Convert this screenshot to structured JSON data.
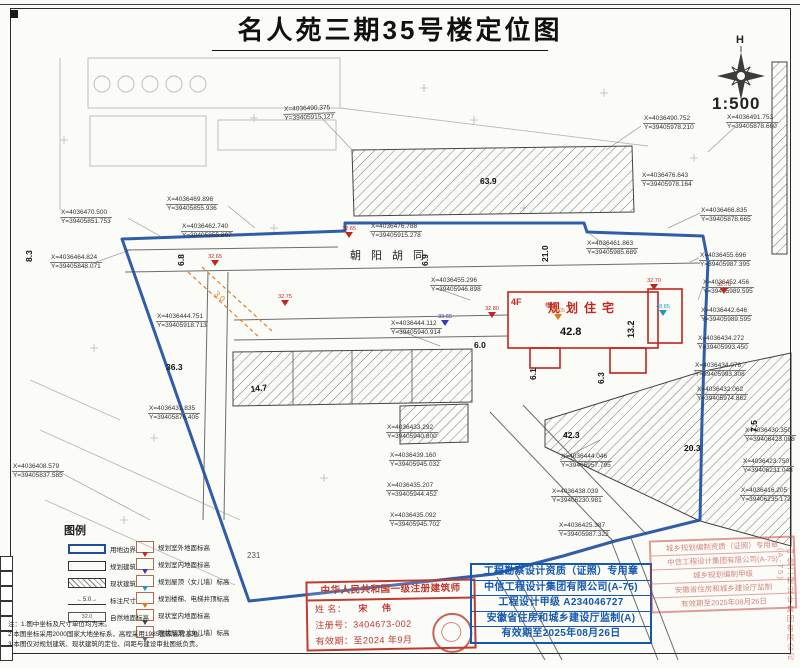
{
  "title": "名人苑三期35号楼定位图",
  "compass": {
    "north_label": "H",
    "scale": "1:500"
  },
  "map": {
    "street_name": "朝阳胡同",
    "building": {
      "floors": "4F",
      "label": "规划住宅",
      "width": "42.8",
      "depth": "13.2",
      "stair_label": "楼梯"
    },
    "orange_annotation": "3.0",
    "parcel_number": "231",
    "coord_labels": [
      {
        "x": 283,
        "y": 106,
        "rot": -2,
        "X": "X=4036490.375",
        "Y": "Y=39405915.127"
      },
      {
        "x": 643,
        "y": 115,
        "X": "X=4036490.752",
        "Y": "Y=39405978.210"
      },
      {
        "x": 641,
        "y": 172,
        "X": "X=4036476.643",
        "Y": "Y=39405978.164"
      },
      {
        "x": 726,
        "y": 114,
        "X": "X=4036491.753",
        "Y": "Y=39405878.660"
      },
      {
        "x": 700,
        "y": 207,
        "X": "X=4036466.835",
        "Y": "Y=39405878.665"
      },
      {
        "x": 166,
        "y": 196,
        "X": "X=4036469.896",
        "Y": "Y=39405855.936"
      },
      {
        "x": 60,
        "y": 209,
        "X": "X=4036470.500",
        "Y": "Y=39405851.753"
      },
      {
        "x": 181,
        "y": 223,
        "X": "X=4036462.740",
        "Y": "Y=39405855.897"
      },
      {
        "x": 370,
        "y": 223,
        "X": "X=4036476.788",
        "Y": "Y=39405915.278"
      },
      {
        "x": 50,
        "y": 254,
        "X": "X=4036464.824",
        "Y": "Y=39405848.071"
      },
      {
        "x": 586,
        "y": 240,
        "X": "X=4036461.863",
        "Y": "Y=39405985.689"
      },
      {
        "x": 699,
        "y": 252,
        "X": "X=4036455.696",
        "Y": "Y=39405987.395"
      },
      {
        "x": 702,
        "y": 279,
        "X": "X=4036452.456",
        "Y": "Y=39405989.595"
      },
      {
        "x": 700,
        "y": 307,
        "X": "X=4036442.646",
        "Y": "Y=39405989.595"
      },
      {
        "x": 697,
        "y": 335,
        "X": "X=4036434.272",
        "Y": "Y=39405993.450"
      },
      {
        "x": 694,
        "y": 362,
        "X": "X=4036434.076",
        "Y": "Y=39405993.308"
      },
      {
        "x": 696,
        "y": 386,
        "X": "X=4036432.062",
        "Y": "Y=39405974.862"
      },
      {
        "x": 430,
        "y": 277,
        "X": "X=4036455.296",
        "Y": "Y=39405946.898"
      },
      {
        "x": 390,
        "y": 320,
        "X": "X=4036444.112",
        "Y": "Y=39405940.914"
      },
      {
        "x": 156,
        "y": 313,
        "X": "X=4036444.751",
        "Y": "Y=39405918.713"
      },
      {
        "x": 148,
        "y": 405,
        "X": "X=4036431.835",
        "Y": "Y=39405876.405"
      },
      {
        "x": 386,
        "y": 424,
        "X": "X=4036433.292",
        "Y": "Y=39405940.800"
      },
      {
        "x": 389,
        "y": 452,
        "X": "X=4036439.160",
        "Y": "Y=39405945.032"
      },
      {
        "x": 386,
        "y": 482,
        "X": "X=4036435.207",
        "Y": "Y=39405944.452"
      },
      {
        "x": 389,
        "y": 512,
        "X": "X=4036435.092",
        "Y": "Y=39405945.702"
      },
      {
        "x": 560,
        "y": 453,
        "X": "X=4036444.046",
        "Y": "Y=39405957.795"
      },
      {
        "x": 551,
        "y": 488,
        "X": "X=4036438.039",
        "Y": "Y=39406230.981"
      },
      {
        "x": 558,
        "y": 522,
        "X": "X=4036425.387",
        "Y": "Y=39405987.322"
      },
      {
        "x": 12,
        "y": 463,
        "X": "X=4036408.579",
        "Y": "Y=39405837.585"
      },
      {
        "x": 744,
        "y": 427,
        "X": "X=4036430.350",
        "Y": "Y=39406423.098"
      },
      {
        "x": 742,
        "y": 458,
        "X": "X=4036423.750",
        "Y": "Y=39406231.048"
      },
      {
        "x": 740,
        "y": 487,
        "X": "X=4036416.205",
        "Y": "Y=39406235.172"
      }
    ],
    "dimensions": [
      {
        "x": 24,
        "y": 262,
        "rot": -90,
        "t": "8.3"
      },
      {
        "x": 176,
        "y": 266,
        "rot": -90,
        "t": "6.8"
      },
      {
        "x": 420,
        "y": 266,
        "rot": -90,
        "t": "6.9"
      },
      {
        "x": 540,
        "y": 262,
        "rot": -90,
        "t": "21.0"
      },
      {
        "x": 474,
        "y": 340,
        "t": "6.0"
      },
      {
        "x": 528,
        "y": 380,
        "rot": -90,
        "t": "6.1"
      },
      {
        "x": 596,
        "y": 384,
        "rot": -90,
        "t": "6.3"
      },
      {
        "x": 480,
        "y": 176,
        "t": "63.9"
      },
      {
        "x": 250,
        "y": 384,
        "rot": -6,
        "t": "14.7"
      },
      {
        "x": 166,
        "y": 362,
        "t": "36.3"
      },
      {
        "x": 563,
        "y": 430,
        "t": "42.3"
      },
      {
        "x": 684,
        "y": 443,
        "t": "20.3"
      },
      {
        "x": 749,
        "y": 432,
        "rot": -90,
        "t": "7.5"
      }
    ],
    "elev_markers": [
      {
        "x": 204,
        "y": 254,
        "c": "red",
        "v": "32.65"
      },
      {
        "x": 338,
        "y": 226,
        "c": "red",
        "v": "32.65"
      },
      {
        "x": 274,
        "y": 294,
        "c": "red",
        "v": "32.75"
      },
      {
        "x": 434,
        "y": 314,
        "c": "blue",
        "v": "33.65"
      },
      {
        "x": 481,
        "y": 306,
        "c": "red",
        "v": "32.80"
      },
      {
        "x": 547,
        "y": 308,
        "c": "orange",
        "v": "38.05"
      },
      {
        "x": 643,
        "y": 278,
        "c": "red",
        "v": "32.70"
      },
      {
        "x": 652,
        "y": 304,
        "c": "cyan",
        "v": "48.85"
      },
      {
        "x": 713,
        "y": 282,
        "c": "red",
        "v": "32.70"
      }
    ]
  },
  "legend": {
    "title": "图例",
    "dim_example": "5.0",
    "ground_example": "32.0",
    "left": [
      {
        "label": "用地边界"
      },
      {
        "label": "规划建筑"
      },
      {
        "label": "现状建筑"
      },
      {
        "label": "标注尺寸"
      },
      {
        "label": "自然地面标高"
      }
    ],
    "right": [
      {
        "c": "red",
        "label": "规划室外地面标高"
      },
      {
        "c": "blue",
        "label": "规划室内地面标高"
      },
      {
        "c": "cyan",
        "label": "规划屋顶（女儿墙）标高"
      },
      {
        "c": "orange",
        "label": "规划楼梯、电梯井顶标高"
      },
      {
        "c": "dark",
        "label": "现状室内地面标高"
      },
      {
        "c": "dark2",
        "label": "现状屋顶（女儿墙）标高"
      }
    ]
  },
  "notes": [
    {
      "t": "注：1.图中坐标及尺寸单位均为米。"
    },
    {
      "t": "2.本图坐标采用2000国家大地坐标系，高程采用1985国家高程基准。"
    },
    {
      "t": "3.本图仅对规划建筑、现状建筑的定位、间距与建设审批图纸负责。"
    }
  ],
  "stamps": {
    "architect": {
      "title": "中华人民共和国一级注册建筑师",
      "name_label": "姓 名：",
      "name": "宋 伟",
      "no_label": "注册号：",
      "no": "3404673-002",
      "valid_label": "有效期：",
      "valid": "至2024 年9月"
    },
    "blue": {
      "lines": [
        "工程勘察设计资质（证照）专用章",
        "中信工程设计集团有限公司(A-75)",
        "工程设计甲级 A234046727",
        "安徽省住房和城乡建设厅监制(A)",
        "有效期至2025年08月26日"
      ]
    },
    "red_right": {
      "lines": [
        "城乡规划编制资质（证照）专用章",
        "中信工程设计集团有限公司(A-75)",
        "城乡规划编制甲级",
        "安徽省住房和城乡建设厅监制",
        "有效期至2025年08月26日"
      ]
    }
  },
  "side_text": "中信工程设计集团有限公司(A-75)",
  "colors": {
    "boundary_blue": "#1d4fa0",
    "planned_red": "#c2251d",
    "stamp_blue": "#1558b0",
    "stamp_red": "#c03a2e",
    "orange_annotation": "#e08030"
  }
}
